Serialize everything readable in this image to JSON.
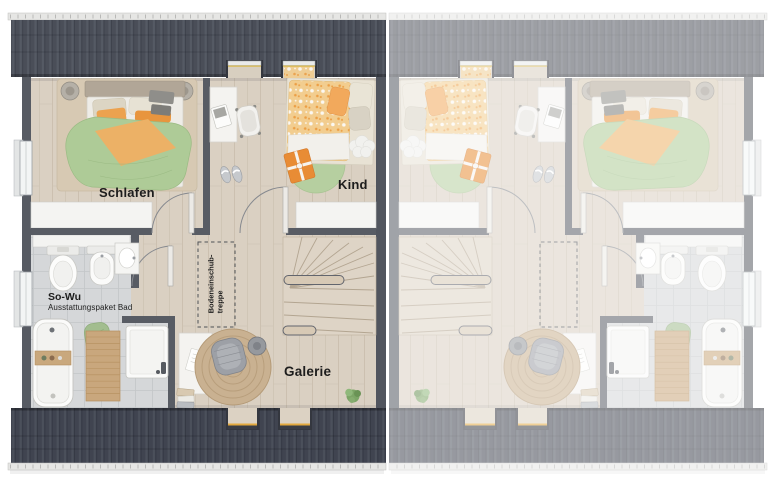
{
  "floorplan": {
    "type": "attic-floor-plan-semi-detached-house",
    "unit_labels": {
      "bedroom": "Schlafen",
      "child_room": "Kind",
      "bath_package_title": "So-Wu",
      "bath_package_subtitle": "Ausstattungspaket Bad",
      "attic_ladder_line1": "Bodeneinschub-",
      "attic_ladder_line2": "treppe",
      "gallery": "Galerie"
    },
    "mirrored_right_unit_labels": [],
    "palette": {
      "roof_dark_top": "#4a4e58",
      "roof_dark_bottom": "#404450",
      "roof_faded_overlay": "#ffffff",
      "gutter": "#e6e6e4",
      "wall": "#585c64",
      "party_wall": "#51555e",
      "floor_wood": "#dad0c2",
      "bath_tile": "#d5d7d9",
      "knee_wall_white": "#f4f4f2",
      "duvet_green": "#aecb97",
      "duvet_orange": "#ecb166",
      "pillow_orange": "#e8953e",
      "child_duvet_floral": "#f2cd8f",
      "rug_green": "#b6cfa0",
      "rug_jute": "#c9b191",
      "stairs_wood": "#ded4c6",
      "fixture_white": "#fbfbfa",
      "dormer_sill_yellow": "#e3a93e",
      "text": "#1d1d1d"
    }
  }
}
